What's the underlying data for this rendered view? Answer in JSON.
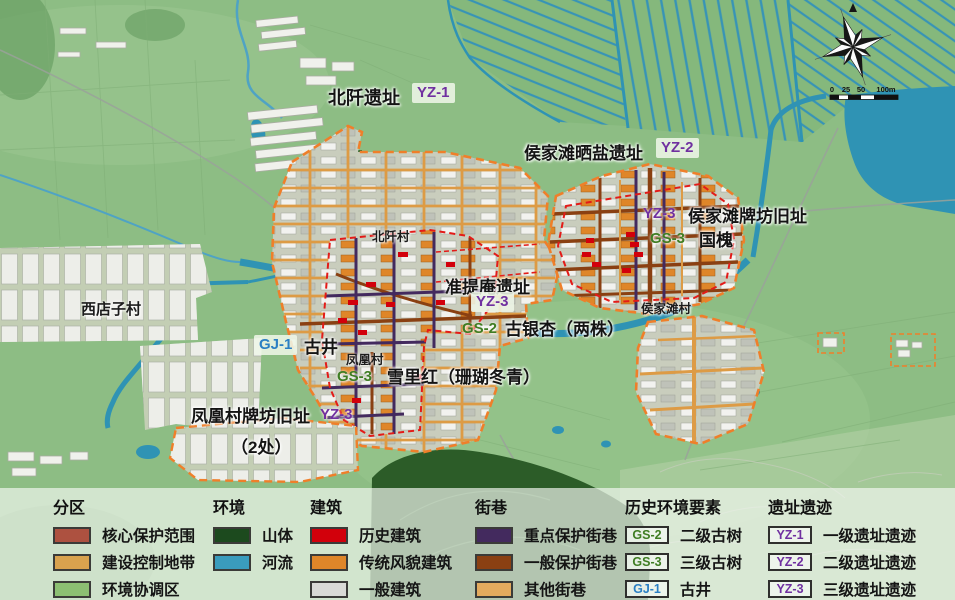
{
  "map": {
    "annotations": {
      "beiqian": {
        "title": "北阡遗址",
        "badge": "YZ-1"
      },
      "shaiyan": {
        "title": "侯家滩晒盐遗址",
        "badge": "YZ-2"
      },
      "hjt_paifang": {
        "title": "侯家滩牌坊旧址",
        "badge": "YZ-3"
      },
      "guohuai": {
        "title": "国槐",
        "badge": "GS-3"
      },
      "zhunti_an": {
        "title": "准提庵遗址",
        "badge": "YZ-3"
      },
      "guyinxing": {
        "title": "古银杏（两株）",
        "badge": "GS-2"
      },
      "gujing": {
        "title": "古井",
        "badge": "GJ-1"
      },
      "xuelihong": {
        "title": "雪里红（珊瑚冬青）",
        "badge": "GS-3"
      },
      "fh_paifang": {
        "title": "凤凰村牌坊旧址",
        "subtitle": "（2处）",
        "badge": "YZ-3"
      }
    },
    "villages": {
      "xidianzi": "西店子村",
      "beiqian": "北阡村",
      "fenghuang": "凤凰村",
      "houjiatan": "侯家滩村"
    },
    "scale_bar": {
      "labels": [
        "0",
        "25",
        "50",
        "100m"
      ]
    }
  },
  "legend": {
    "sections": [
      {
        "title": "分区",
        "items": [
          {
            "label": "核心保护范围",
            "color": "#ad5140"
          },
          {
            "label": "建设控制地带",
            "color": "#d9a24e"
          },
          {
            "label": "环境协调区",
            "color": "#8cbf72"
          }
        ]
      },
      {
        "title": "环境",
        "items": [
          {
            "label": "山体",
            "color": "#1c4a1e"
          },
          {
            "label": "河流",
            "color": "#3a9cbd"
          }
        ]
      },
      {
        "title": "建筑",
        "items": [
          {
            "label": "历史建筑",
            "color": "#d2000b"
          },
          {
            "label": "传统风貌建筑",
            "color": "#df8629"
          },
          {
            "label": "一般建筑",
            "color": "#d9dad6"
          }
        ]
      },
      {
        "title": "街巷",
        "items": [
          {
            "label": "重点保护街巷",
            "color": "#432a5e"
          },
          {
            "label": "一般保护街巷",
            "color": "#8a4012"
          },
          {
            "label": "其他街巷",
            "color": "#e3aa5e"
          }
        ]
      },
      {
        "title": "历史环境要素",
        "items": [
          {
            "badge": "GS-2",
            "color": "#3f7d23",
            "label": "二级古树"
          },
          {
            "badge": "GS-3",
            "color": "#3f7d23",
            "label": "三级古树"
          },
          {
            "badge": "GJ-1",
            "color": "#2b7fc3",
            "label": "古井"
          }
        ]
      },
      {
        "title": "遗址遗迹",
        "items": [
          {
            "badge": "YZ-1",
            "color": "#7030a0",
            "label": "一级遗址遗迹"
          },
          {
            "badge": "YZ-2",
            "color": "#7030a0",
            "label": "二级遗址遗迹"
          },
          {
            "badge": "YZ-3",
            "color": "#7030a0",
            "label": "三级遗址遗迹"
          }
        ]
      }
    ]
  }
}
